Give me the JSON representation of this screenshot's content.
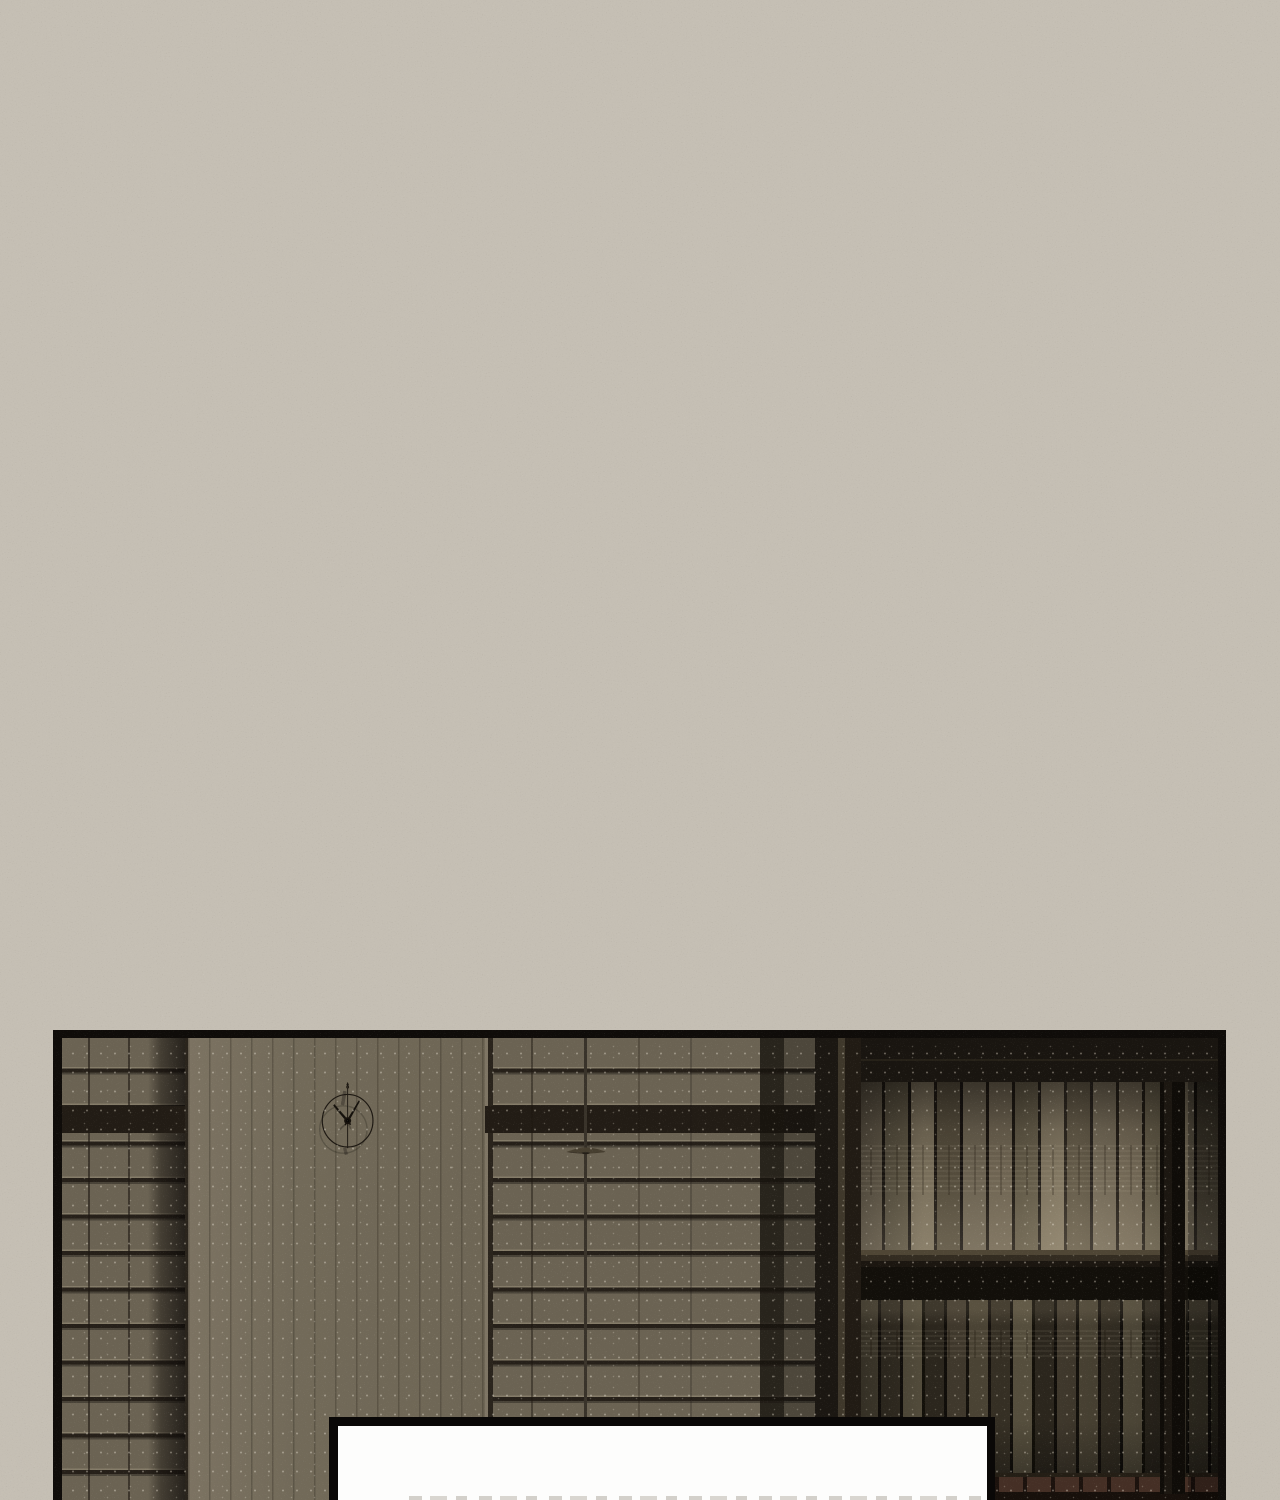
{
  "scene": {
    "type": "webtoon-comic-panel",
    "background_color": "#c5bfb4",
    "panel": {
      "border_color": "#0f0c09",
      "left_blinds_color": "#6b6353",
      "wall_color": "#726a59",
      "center_blinds_color": "#6b6352",
      "rail_color": "#221c15",
      "clock": {
        "color": "#1d1812",
        "approx_time_shown": "10:09"
      },
      "pendant_lamp_color": "#473f30",
      "bookshelf": {
        "frame_color": "#17130e",
        "book_spine_colors": [
          "#786e5a",
          "#6e6452",
          "#544c3c",
          "#352f24",
          "#452f25"
        ]
      }
    },
    "speech_box": {
      "fill": "#fdfdfc",
      "border_color": "#0a0807",
      "text": ""
    }
  }
}
